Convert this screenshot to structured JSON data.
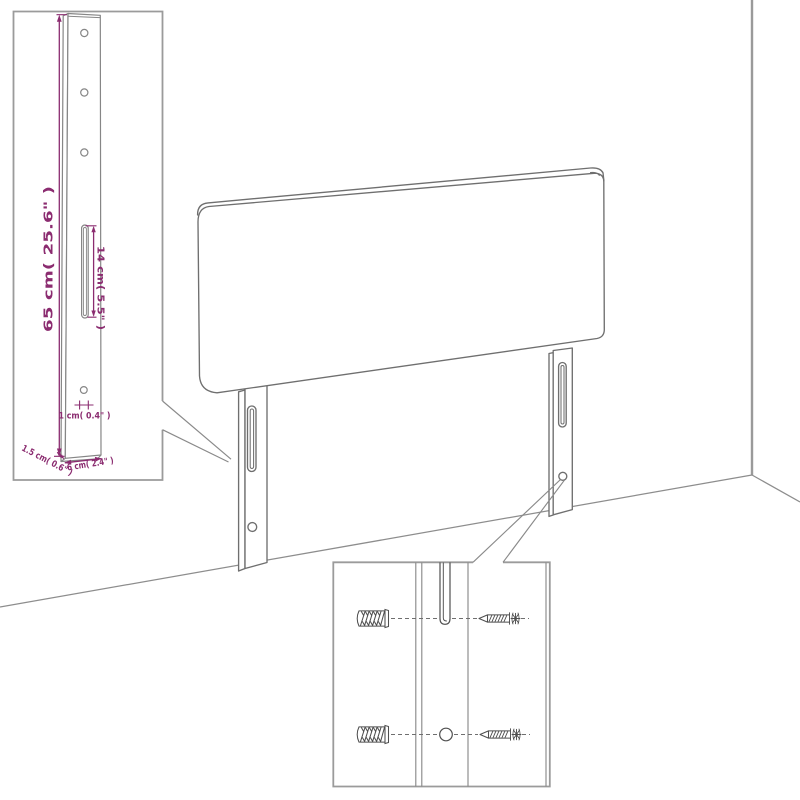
{
  "diagram": {
    "kind": "headboard-assembly-dimension-diagram"
  },
  "colors": {
    "dimension": "#8b2c70",
    "outline": "#6f6f6f",
    "inset_outline": "#868686",
    "frame": "#9b9b9b",
    "wall": "#9a9a9a",
    "background": "#ffffff"
  },
  "insets": {
    "leg_detail": {
      "dimensions": {
        "height": "65 cm( 25.6\" )",
        "slot_length": "14 cm( 5.5\" )",
        "hole_diameter": "1 cm( 0.4\" )",
        "thickness": "1.5 cm( 0.6\" )",
        "width": "6 cm( 2.4\" )"
      }
    },
    "mount_detail": {
      "icons": [
        "wall-plug-icon",
        "screw-icon",
        "slot-icon",
        "hole-icon"
      ]
    }
  }
}
